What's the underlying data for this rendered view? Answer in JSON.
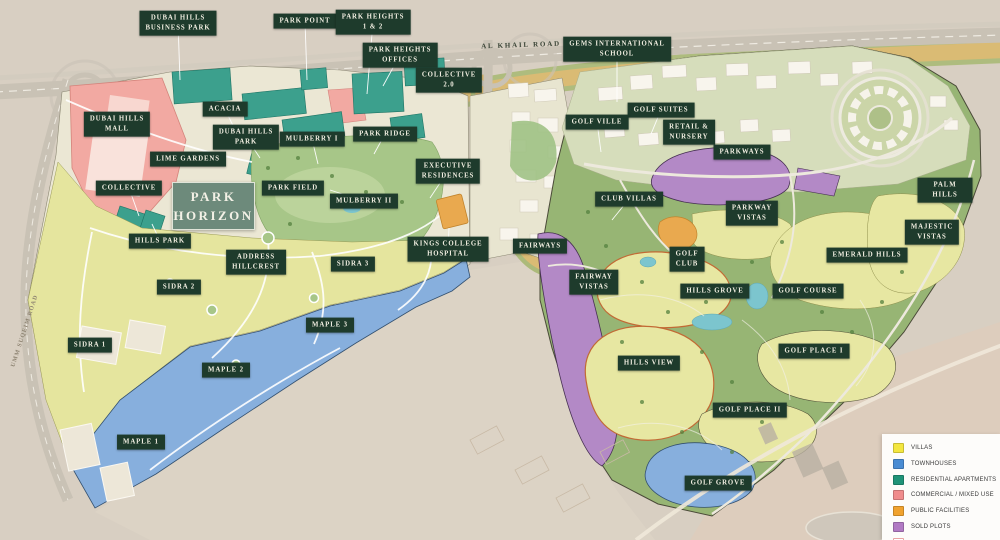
{
  "map": {
    "title_label": {
      "text": "PARK HORIZON"
    },
    "road_labels": [
      {
        "text": "AL KHAIL ROAD"
      },
      {
        "text": "UMM SUQEIM ROAD"
      }
    ],
    "area_labels": [
      {
        "name": "dubai-hills-business-park",
        "text": "DUBAI HILLS\nBUSINESS PARK",
        "x": 178,
        "y": 23,
        "leader": [
          180,
          80
        ]
      },
      {
        "name": "park-point",
        "text": "PARK POINT",
        "x": 305,
        "y": 21,
        "leader": [
          307,
          80
        ]
      },
      {
        "name": "park-heights-1-2",
        "text": "PARK HEIGHTS\n1 & 2",
        "x": 373,
        "y": 22,
        "leader": [
          367,
          94
        ]
      },
      {
        "name": "park-heights-offices",
        "text": "PARK HEIGHTS\nOFFICES",
        "x": 400,
        "y": 55,
        "leader": [
          383,
          86
        ]
      },
      {
        "name": "gems-international-school",
        "text": "GEMS INTERNATIONAL\nSCHOOL",
        "x": 617,
        "y": 49,
        "leader": [
          617,
          102
        ]
      },
      {
        "name": "collective-2-0",
        "text": "COLLECTIVE\n2.0",
        "x": 449,
        "y": 80
      },
      {
        "name": "golf-suites",
        "text": "GOLF SUITES",
        "x": 661,
        "y": 110,
        "leader": [
          651,
          134
        ]
      },
      {
        "name": "golf-ville",
        "text": "GOLF VILLE",
        "x": 597,
        "y": 122,
        "leader": [
          601,
          152
        ]
      },
      {
        "name": "retail-nursery",
        "text": "RETAIL &\nNURSERY",
        "x": 689,
        "y": 132
      },
      {
        "name": "parkways",
        "text": "PARKWAYS",
        "x": 742,
        "y": 152
      },
      {
        "name": "acacia",
        "text": "ACACIA",
        "x": 225,
        "y": 109,
        "leader": [
          236,
          132
        ]
      },
      {
        "name": "dubai-hills-mall",
        "text": "DUBAI HILLS\nMALL",
        "x": 117,
        "y": 124
      },
      {
        "name": "dubai-hills-park",
        "text": "DUBAI HILLS\nPARK",
        "x": 246,
        "y": 137,
        "leader": [
          260,
          158
        ]
      },
      {
        "name": "mulberry-i",
        "text": "MULBERRY I",
        "x": 312,
        "y": 139,
        "leader": [
          318,
          164
        ]
      },
      {
        "name": "park-ridge",
        "text": "PARK RIDGE",
        "x": 385,
        "y": 134,
        "leader": [
          374,
          154
        ]
      },
      {
        "name": "lime-gardens",
        "text": "LIME GARDENS",
        "x": 188,
        "y": 159
      },
      {
        "name": "collective",
        "text": "COLLECTIVE",
        "x": 129,
        "y": 188,
        "leader": [
          139,
          216
        ]
      },
      {
        "name": "park-field",
        "text": "PARK FIELD",
        "x": 293,
        "y": 188
      },
      {
        "name": "mulberry-ii",
        "text": "MULBERRY II",
        "x": 364,
        "y": 201,
        "leader": [
          330,
          190
        ]
      },
      {
        "name": "executive-residences",
        "text": "EXECUTIVE\nRESIDENCES",
        "x": 448,
        "y": 171,
        "leader": [
          430,
          198
        ]
      },
      {
        "name": "kings-college-hospital",
        "text": "KINGS COLLEGE\nHOSPITAL",
        "x": 448,
        "y": 249,
        "leader": [
          449,
          228
        ]
      },
      {
        "name": "club-villas",
        "text": "CLUB VILLAS",
        "x": 629,
        "y": 199,
        "leader": [
          612,
          220
        ]
      },
      {
        "name": "golf-club",
        "text": "GOLF\nCLUB",
        "x": 687,
        "y": 259
      },
      {
        "name": "parkway-vistas",
        "text": "PARKWAY\nVISTAS",
        "x": 752,
        "y": 213
      },
      {
        "name": "palm-hills",
        "text": "PALM HILLS",
        "x": 945,
        "y": 190
      },
      {
        "name": "majestic-vistas",
        "text": "MAJESTIC\nVISTAS",
        "x": 932,
        "y": 232
      },
      {
        "name": "emerald-hills",
        "text": "EMERALD HILLS",
        "x": 867,
        "y": 255
      },
      {
        "name": "hills-grove",
        "text": "HILLS GROVE",
        "x": 715,
        "y": 291
      },
      {
        "name": "golf-course",
        "text": "GOLF COURSE",
        "x": 808,
        "y": 291
      },
      {
        "name": "fairways",
        "text": "FAIRWAYS",
        "x": 540,
        "y": 246
      },
      {
        "name": "fairway-vistas",
        "text": "FAIRWAY\nVISTAS",
        "x": 594,
        "y": 282
      },
      {
        "name": "hills-view",
        "text": "HILLS VIEW",
        "x": 649,
        "y": 363
      },
      {
        "name": "golf-place-i",
        "text": "GOLF PLACE I",
        "x": 814,
        "y": 351
      },
      {
        "name": "golf-place-ii",
        "text": "GOLF PLACE II",
        "x": 750,
        "y": 410
      },
      {
        "name": "golf-grove",
        "text": "GOLF GROVE",
        "x": 718,
        "y": 483
      },
      {
        "name": "hills-park",
        "text": "HILLS PARK",
        "x": 160,
        "y": 241,
        "leader": [
          152,
          224
        ]
      },
      {
        "name": "address-hillcrest",
        "text": "ADDRESS\nHILLCREST",
        "x": 256,
        "y": 262
      },
      {
        "name": "sidra-3",
        "text": "SIDRA 3",
        "x": 353,
        "y": 264
      },
      {
        "name": "sidra-2",
        "text": "SIDRA 2",
        "x": 179,
        "y": 287
      },
      {
        "name": "sidra-1",
        "text": "SIDRA 1",
        "x": 90,
        "y": 345
      },
      {
        "name": "maple-3",
        "text": "MAPLE 3",
        "x": 330,
        "y": 325
      },
      {
        "name": "maple-2",
        "text": "MAPLE 2",
        "x": 226,
        "y": 370
      },
      {
        "name": "maple-1",
        "text": "MAPLE 1",
        "x": 141,
        "y": 442
      }
    ]
  },
  "legend": {
    "items": [
      {
        "label": "VILLAS",
        "color": "#F3E63F"
      },
      {
        "label": "TOWNHOUSES",
        "color": "#4A8CD3"
      },
      {
        "label": "RESIDENTIAL APARTMENTS",
        "color": "#1F9378"
      },
      {
        "label": "COMMERCIAL / MIXED USE",
        "color": "#F08C8C"
      },
      {
        "label": "PUBLIC FACILITIES",
        "color": "#F0A22E"
      },
      {
        "label": "SOLD PLOTS",
        "color": "#B17AC4"
      },
      {
        "label": "SHELL AND CORE PLOTS",
        "color": "#FFFFFF",
        "border": "#E9A3A3"
      }
    ]
  },
  "colors": {
    "label_background": "#1E3B2C",
    "title_box": "#6D8A7B",
    "desert_sand": "#D8CFC2",
    "golf_green": "#97B574"
  }
}
